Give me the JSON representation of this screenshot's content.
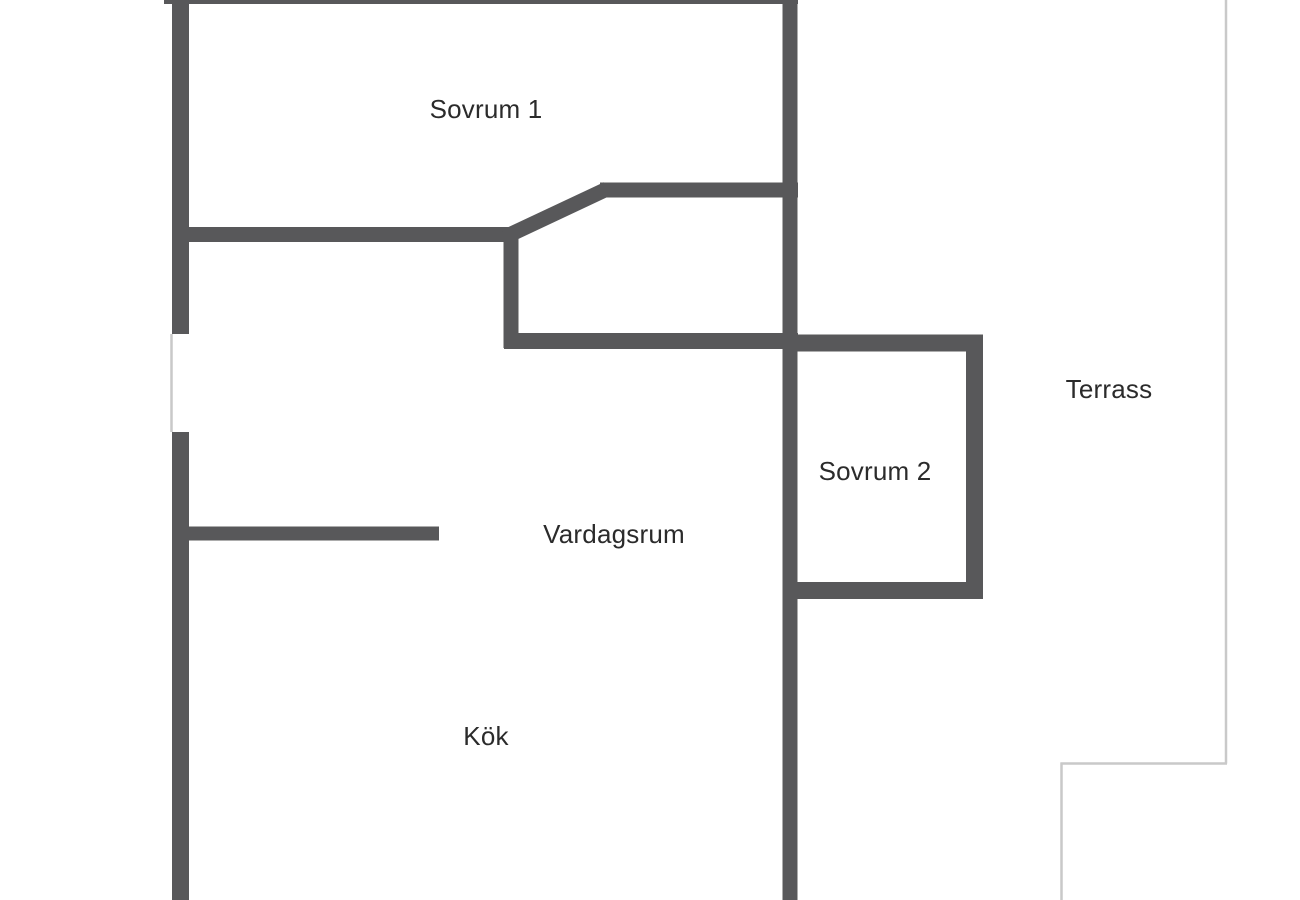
{
  "floor_plan": {
    "type": "apartment-floor-plan",
    "rooms": [
      {
        "id": "sovrum-1",
        "label": "Sovrum 1"
      },
      {
        "id": "sovrum-2",
        "label": "Sovrum 2"
      },
      {
        "id": "vardagsrum",
        "label": "Vardagsrum"
      },
      {
        "id": "kok",
        "label": "Kök"
      },
      {
        "id": "terrass",
        "label": "Terrass"
      }
    ],
    "colors": {
      "wall": "#58585a",
      "terrace_outline": "#c9c9c9",
      "window_marker": "#c9c9c9",
      "label_text": "#2b2b2b",
      "background": "#ffffff"
    }
  }
}
